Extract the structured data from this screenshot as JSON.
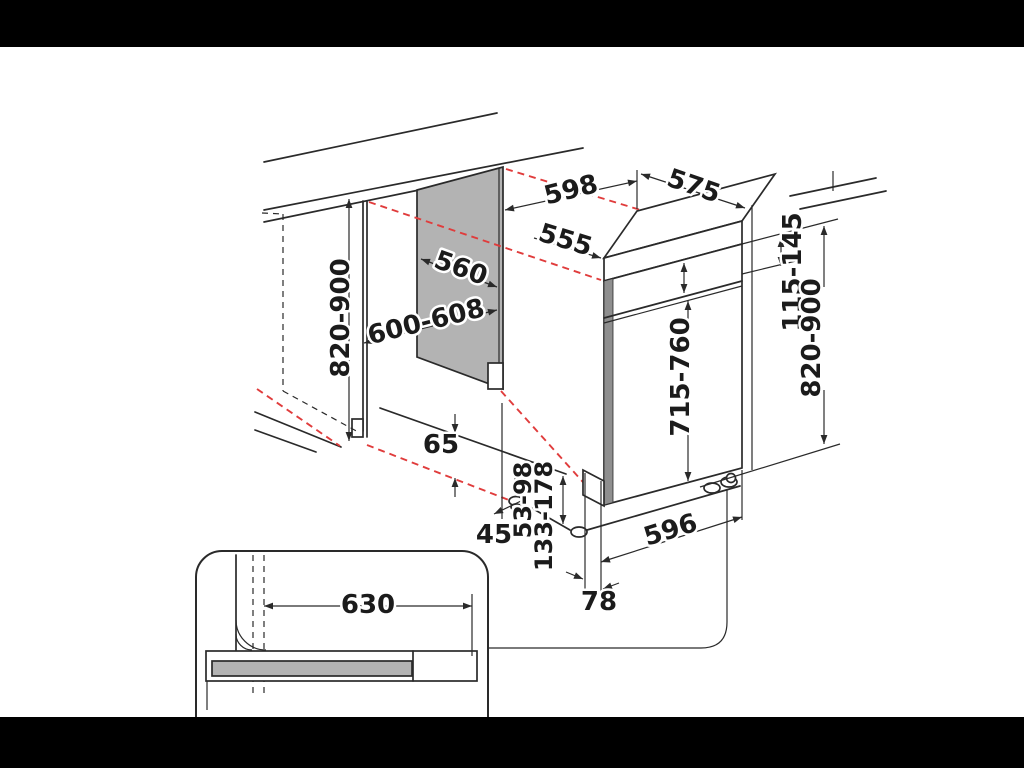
{
  "diagram": {
    "type": "appliance-installation-dimension-drawing",
    "unit_note": "values as printed on drawing (millimetres)",
    "labels": {
      "niche_height_left": "820-900",
      "niche_depth": "560",
      "niche_width": "600-608",
      "appliance_width_top": "598",
      "appliance_depth_top": "575",
      "top_recess_width": "555",
      "top_strip_height": "115-145",
      "overall_height_right": "820-900",
      "door_height": "715-760",
      "floor_clearance": "65",
      "front_offset": "45",
      "foot_range_inner": "53-98",
      "foot_range_outer": "133-178",
      "base_width": "596",
      "foot_depth": "78",
      "plinth_recess_width": "630"
    },
    "colors": {
      "line": "#2a2a2a",
      "niche_panel_fill": "#b3b3b3",
      "door_edge_fill": "#8f8f8f",
      "alignment_guide_red": "#e03c3c",
      "background": "#ffffff",
      "letterbox": "#000000"
    }
  }
}
